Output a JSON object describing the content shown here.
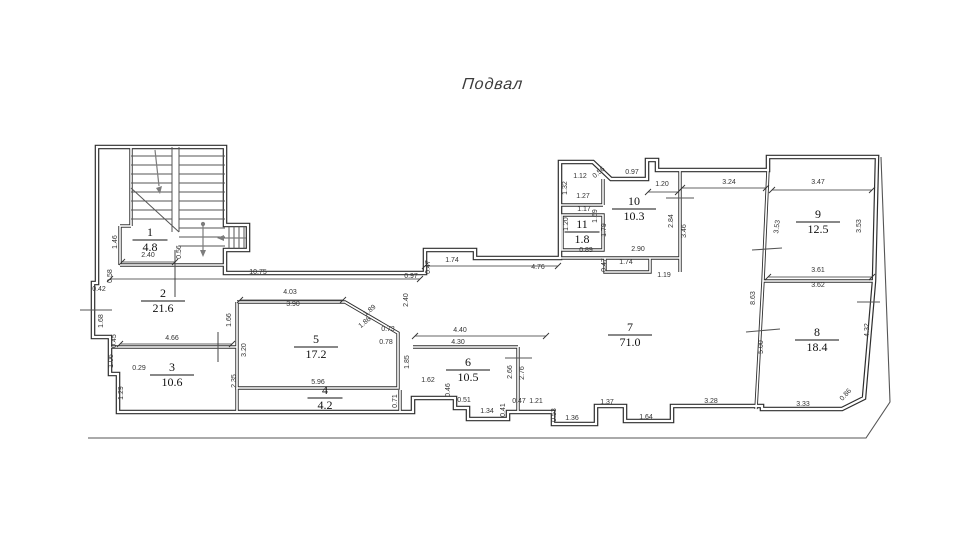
{
  "title": "Подвал",
  "colors": {
    "wall": "#2e2e2e",
    "thin": "#555555",
    "dim": "#333333",
    "walk": "#7d7d7d",
    "paper": "#ffffff"
  },
  "rooms": [
    {
      "number": "1",
      "area": "4.8",
      "x": 150,
      "y": 240
    },
    {
      "number": "2",
      "area": "21.6",
      "x": 163,
      "y": 301
    },
    {
      "number": "3",
      "area": "10.6",
      "x": 172,
      "y": 375
    },
    {
      "number": "4",
      "area": "4.2",
      "x": 325,
      "y": 398
    },
    {
      "number": "5",
      "area": "17.2",
      "x": 316,
      "y": 347
    },
    {
      "number": "6",
      "area": "10.5",
      "x": 468,
      "y": 370
    },
    {
      "number": "7",
      "area": "71.0",
      "x": 630,
      "y": 335
    },
    {
      "number": "8",
      "area": "18.4",
      "x": 817,
      "y": 340
    },
    {
      "number": "9",
      "area": "12.5",
      "x": 818,
      "y": 222
    },
    {
      "number": "10",
      "area": "10.3",
      "x": 634,
      "y": 209
    },
    {
      "number": "11",
      "area": "1.8",
      "x": 582,
      "y": 232
    }
  ],
  "dims": [
    {
      "v": "1.46",
      "x": 117,
      "y": 242,
      "r": -90
    },
    {
      "v": "2.40",
      "x": 148,
      "y": 257,
      "r": 0
    },
    {
      "v": "0.56",
      "x": 181,
      "y": 252,
      "r": -90
    },
    {
      "v": "10.75",
      "x": 258,
      "y": 274,
      "r": 0
    },
    {
      "v": "0.58",
      "x": 112,
      "y": 276,
      "r": -90
    },
    {
      "v": "0.42",
      "x": 99,
      "y": 291,
      "r": 0
    },
    {
      "v": "1.68",
      "x": 103,
      "y": 321,
      "r": -90
    },
    {
      "v": "0.45",
      "x": 116,
      "y": 341,
      "r": -90
    },
    {
      "v": "1.06",
      "x": 113,
      "y": 361,
      "r": -90
    },
    {
      "v": "0.29",
      "x": 139,
      "y": 370,
      "r": 0
    },
    {
      "v": "1.29",
      "x": 123,
      "y": 393,
      "r": -90
    },
    {
      "v": "4.66",
      "x": 172,
      "y": 340,
      "r": 0
    },
    {
      "v": "1.66",
      "x": 231,
      "y": 320,
      "r": -90
    },
    {
      "v": "3.20",
      "x": 246,
      "y": 350,
      "r": -90
    },
    {
      "v": "2.35",
      "x": 236,
      "y": 381,
      "r": -90
    },
    {
      "v": "4.03",
      "x": 290,
      "y": 294,
      "r": 0
    },
    {
      "v": "3.90",
      "x": 293,
      "y": 306,
      "r": 0
    },
    {
      "v": "1.89",
      "x": 371,
      "y": 312,
      "r": -40
    },
    {
      "v": "1.86",
      "x": 366,
      "y": 324,
      "r": -40
    },
    {
      "v": "0.73",
      "x": 388,
      "y": 331,
      "r": 0
    },
    {
      "v": "0.78",
      "x": 386,
      "y": 344,
      "r": 0
    },
    {
      "v": "2.40",
      "x": 408,
      "y": 300,
      "r": -90
    },
    {
      "v": "0.97",
      "x": 411,
      "y": 278,
      "r": 0
    },
    {
      "v": "0.47",
      "x": 430,
      "y": 267,
      "r": -90
    },
    {
      "v": "1.74",
      "x": 452,
      "y": 262,
      "r": 0
    },
    {
      "v": "4.76",
      "x": 538,
      "y": 269,
      "r": 0
    },
    {
      "v": "5.96",
      "x": 318,
      "y": 384,
      "r": 0
    },
    {
      "v": "1.85",
      "x": 409,
      "y": 362,
      "r": -90
    },
    {
      "v": "0.71",
      "x": 397,
      "y": 401,
      "r": -90
    },
    {
      "v": "4.40",
      "x": 460,
      "y": 332,
      "r": 0
    },
    {
      "v": "4.30",
      "x": 458,
      "y": 344,
      "r": 0
    },
    {
      "v": "1.62",
      "x": 428,
      "y": 382,
      "r": 0
    },
    {
      "v": "0.46",
      "x": 450,
      "y": 390,
      "r": -90
    },
    {
      "v": "0.51",
      "x": 464,
      "y": 402,
      "r": 0
    },
    {
      "v": "1.34",
      "x": 487,
      "y": 413,
      "r": 0
    },
    {
      "v": "0.41",
      "x": 505,
      "y": 410,
      "r": -90
    },
    {
      "v": "0.47",
      "x": 519,
      "y": 403,
      "r": 0
    },
    {
      "v": "1.21",
      "x": 536,
      "y": 403,
      "r": 0
    },
    {
      "v": "2.66",
      "x": 512,
      "y": 372,
      "r": -90
    },
    {
      "v": "2.76",
      "x": 524,
      "y": 373,
      "r": -90
    },
    {
      "v": "0.53",
      "x": 556,
      "y": 415,
      "r": -90
    },
    {
      "v": "1.36",
      "x": 572,
      "y": 420,
      "r": 0
    },
    {
      "v": "1.37",
      "x": 607,
      "y": 404,
      "r": 0
    },
    {
      "v": "1.64",
      "x": 646,
      "y": 419,
      "r": 0
    },
    {
      "v": "3.28",
      "x": 711,
      "y": 403,
      "r": 0
    },
    {
      "v": "3.33",
      "x": 803,
      "y": 406,
      "r": 0
    },
    {
      "v": "0.86",
      "x": 847,
      "y": 396,
      "r": -48
    },
    {
      "v": "4.32",
      "x": 869,
      "y": 330,
      "r": -90
    },
    {
      "v": "5.00",
      "x": 763,
      "y": 347,
      "r": -90
    },
    {
      "v": "8.63",
      "x": 755,
      "y": 298,
      "r": -90
    },
    {
      "v": "1.12",
      "x": 580,
      "y": 178,
      "r": 0
    },
    {
      "v": "0.56",
      "x": 600,
      "y": 174,
      "r": -40
    },
    {
      "v": "0.97",
      "x": 632,
      "y": 174,
      "r": 0
    },
    {
      "v": "1.32",
      "x": 567,
      "y": 188,
      "r": -90
    },
    {
      "v": "1.27",
      "x": 583,
      "y": 198,
      "r": 0
    },
    {
      "v": "1.17",
      "x": 584,
      "y": 211,
      "r": 0
    },
    {
      "v": "1.69",
      "x": 597,
      "y": 216,
      "r": -90
    },
    {
      "v": "1.20",
      "x": 568,
      "y": 224,
      "r": -90
    },
    {
      "v": "1.79",
      "x": 606,
      "y": 230,
      "r": -90
    },
    {
      "v": "0.89",
      "x": 586,
      "y": 252,
      "r": 0
    },
    {
      "v": "1.20",
      "x": 662,
      "y": 186,
      "r": 0
    },
    {
      "v": "2.84",
      "x": 673,
      "y": 221,
      "r": -90
    },
    {
      "v": "3.46",
      "x": 686,
      "y": 231,
      "r": -90
    },
    {
      "v": "2.90",
      "x": 638,
      "y": 251,
      "r": 0
    },
    {
      "v": "1.74",
      "x": 626,
      "y": 264,
      "r": 0
    },
    {
      "v": "0.47",
      "x": 606,
      "y": 265,
      "r": -90
    },
    {
      "v": "1.19",
      "x": 664,
      "y": 277,
      "r": 0
    },
    {
      "v": "3.24",
      "x": 729,
      "y": 184,
      "r": 0
    },
    {
      "v": "3.47",
      "x": 818,
      "y": 184,
      "r": 0
    },
    {
      "v": "3.53",
      "x": 779,
      "y": 227,
      "r": -83
    },
    {
      "v": "3.53",
      "x": 861,
      "y": 226,
      "r": -90
    },
    {
      "v": "3.61",
      "x": 818,
      "y": 272,
      "r": 0
    },
    {
      "v": "3.62",
      "x": 818,
      "y": 287,
      "r": 0
    }
  ]
}
